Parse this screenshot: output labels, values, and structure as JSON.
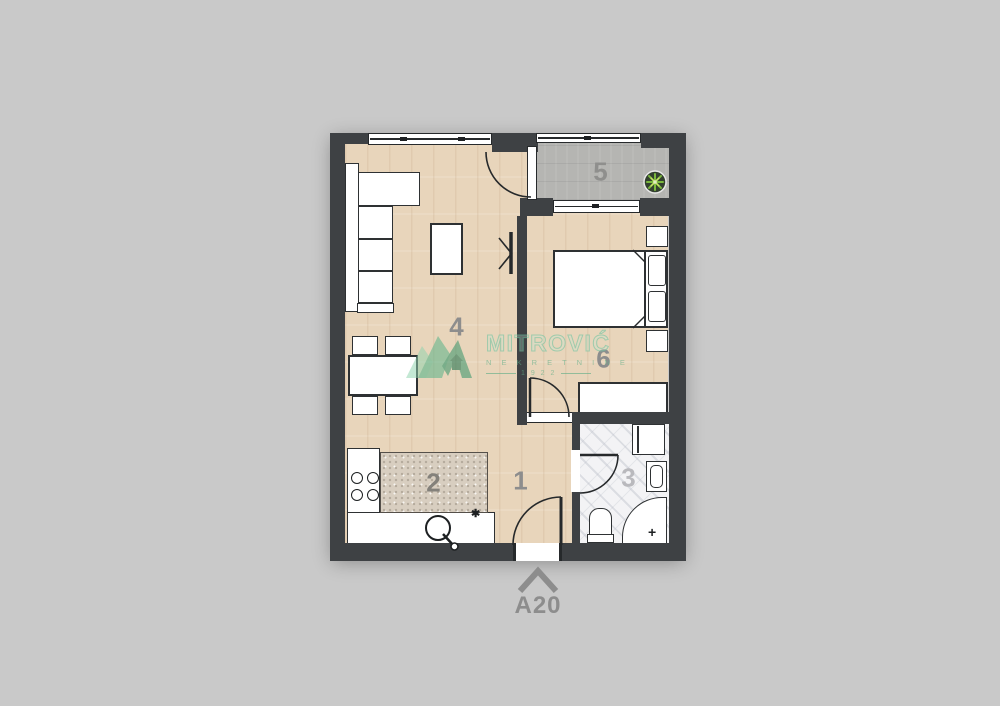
{
  "plan": {
    "unit_label": "A20",
    "room_labels": {
      "hallway": "1",
      "kitchen": "2",
      "bathroom": "3",
      "living_room": "4",
      "terrace": "5",
      "bedroom": "6"
    },
    "symbols": {
      "kitchen_star": "✱",
      "shower_cross": "+"
    },
    "watermark": {
      "brand": "MITROVIĆ",
      "tagline": "N E K R E T N I N E",
      "year_line": "1 9 2 2"
    },
    "colors": {
      "background": "#c9c9c9",
      "wall": "#3e4144",
      "wood_floor": "#e8d5bb",
      "terrace_floor": "#b5b5b2",
      "bathroom_floor": "#f3f3f5",
      "worktop_speckle": "#d8cec0",
      "label_gray": "#8d8d8d",
      "watermark_green": "#5fae87",
      "plant_green": "#7ab83d"
    }
  }
}
